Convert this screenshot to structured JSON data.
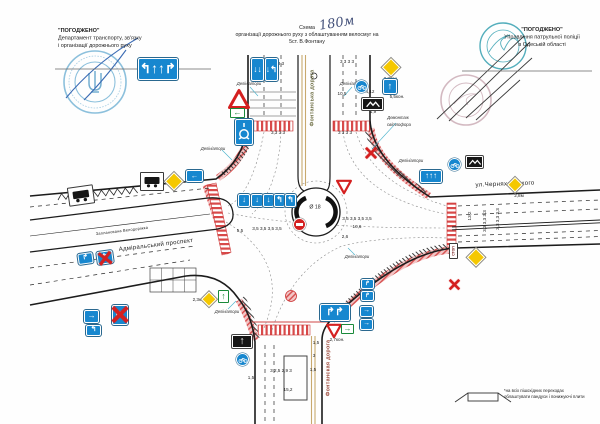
{
  "approvals": {
    "left": {
      "title": "\"ПОГОДЖЕНО\"",
      "line1": "Департамент транспорту, зв'язку",
      "line2": "і організації дорожнього руху"
    },
    "right": {
      "title": "\"ПОГОДЖЕНО\"",
      "line1": "Управління патрульної поліції",
      "line2": "в Одеській області"
    }
  },
  "title": {
    "word": "Схема",
    "handwritten": "180м",
    "line2": "організації дорожнього руху з облаштуванням велосмуг на",
    "line3": "5ст. В.Фонтану"
  },
  "footnote": {
    "line1": "*на всіх пішохідних переходах",
    "line2": "облаштувати пандуси і понижуючі плити"
  },
  "colors": {
    "sign_blue": "#1787cf",
    "diamond_yellow": "#f5c800",
    "marking_red": "#d85454",
    "stamp_blue": "#8cc0dc",
    "stamp_teal": "#54aebc",
    "ink_blue": "#3c6cb4"
  },
  "labels": [
    {
      "n": "street-label-north",
      "t": "Фонтанська дорога",
      "x": 312,
      "y": 98,
      "r": -90,
      "c": "olive street",
      "fs": 5.4
    },
    {
      "n": "street-label-south",
      "t": "Фонтанская дорога",
      "x": 328,
      "y": 368,
      "r": -90,
      "c": "rust street",
      "fs": 5.4
    },
    {
      "n": "street-label-east",
      "t": "ул.Черняховського",
      "x": 505,
      "y": 184,
      "r": -2,
      "c": "street",
      "fs": 6.2
    },
    {
      "n": "street-label-west",
      "t": "Адміральський проспект",
      "x": 156,
      "y": 245,
      "r": -7,
      "c": "street",
      "fs": 6.0
    },
    {
      "n": "bike-lane-label",
      "t": "Запланована Велодоріжка",
      "x": 122,
      "y": 231,
      "r": -7,
      "c": "street",
      "fs": 3.9
    },
    {
      "n": "delineators-label",
      "t": "Делініатори",
      "x": 249,
      "y": 84,
      "c": "annot",
      "fs": 4.2
    },
    {
      "n": "delineators-label",
      "t": "Делініатори",
      "x": 352,
      "y": 84,
      "c": "annot",
      "fs": 4.2
    },
    {
      "n": "delineators-label",
      "t": "Делініатори",
      "x": 213,
      "y": 149,
      "c": "annot",
      "fs": 4.2
    },
    {
      "n": "delineators-label",
      "t": "Делініатори",
      "x": 411,
      "y": 161,
      "c": "annot",
      "fs": 4.2
    },
    {
      "n": "delineators-label",
      "t": "Делініатори",
      "x": 227,
      "y": 312,
      "c": "annot",
      "fs": 4.2
    },
    {
      "n": "delineators-label",
      "t": "Делініатори",
      "x": 357,
      "y": 257,
      "c": "annot",
      "fs": 4.2
    },
    {
      "n": "demontage-label",
      "t": "Демонтаж",
      "x": 398,
      "y": 118,
      "c": "annot",
      "fs": 4.2
    },
    {
      "n": "demontage-label",
      "t": "світлофора",
      "x": 399,
      "y": 125,
      "c": "annot",
      "fs": 4.2
    },
    {
      "n": "roundabout-diameter",
      "t": "Ø 18",
      "x": 315,
      "y": 207,
      "fs": 5.2
    },
    {
      "n": "dimension-label",
      "t": "1,7",
      "x": 253,
      "y": 61
    },
    {
      "n": "dimension-label",
      "t": "3,3 3 3",
      "x": 277,
      "y": 64
    },
    {
      "n": "dimension-label",
      "t": "3 3 3 3",
      "x": 347,
      "y": 62
    },
    {
      "n": "dimension-label",
      "t": "10,5",
      "x": 342,
      "y": 94
    },
    {
      "n": "dimension-label",
      "t": "3,3 3 3",
      "x": 278,
      "y": 133
    },
    {
      "n": "dimension-label",
      "t": "3 3 3 3",
      "x": 345,
      "y": 133
    },
    {
      "n": "dimension-label",
      "t": "2,3кон.",
      "x": 391,
      "y": 79
    },
    {
      "n": "dimension-label",
      "t": "5,5кон.",
      "x": 397,
      "y": 97
    },
    {
      "n": "dimension-label",
      "t": "4,12",
      "x": 370,
      "y": 92
    },
    {
      "n": "dimension-label",
      "t": "1,9",
      "x": 373,
      "y": 112
    },
    {
      "n": "dimension-label",
      "t": "5,5",
      "x": 240,
      "y": 231
    },
    {
      "n": "dimension-label",
      "t": "3,5 3,5 3,5 3,5",
      "x": 267,
      "y": 229
    },
    {
      "n": "dimension-label",
      "t": "3,5 3,5 3,5 3,5",
      "x": 357,
      "y": 219
    },
    {
      "n": "dimension-label",
      "t": "10,6",
      "x": 357,
      "y": 227
    },
    {
      "n": "dimension-label",
      "t": "2,6",
      "x": 345,
      "y": 237
    },
    {
      "n": "dimension-label",
      "t": "13,2",
      "x": 470,
      "y": 216,
      "r": -90
    },
    {
      "n": "dimension-label",
      "t": "3,3 3,3 3,3",
      "x": 485,
      "y": 221,
      "r": -90
    },
    {
      "n": "dimension-label",
      "t": "3,3 3,3 3,3",
      "x": 498,
      "y": 219,
      "r": -90
    },
    {
      "n": "dimension-label",
      "t": "2,8м",
      "x": 519,
      "y": 196
    },
    {
      "n": "dimension-label",
      "t": "5,6",
      "x": 328,
      "y": 321
    },
    {
      "n": "dimension-label",
      "t": "2,7кон.",
      "x": 337,
      "y": 340
    },
    {
      "n": "dimension-label",
      "t": "1,5",
      "x": 316,
      "y": 343
    },
    {
      "n": "dimension-label",
      "t": "3",
      "x": 314,
      "y": 356
    },
    {
      "n": "dimension-label",
      "t": "1,5",
      "x": 313,
      "y": 370
    },
    {
      "n": "dimension-label",
      "t": "3 2,5 2,9 3",
      "x": 281,
      "y": 371
    },
    {
      "n": "dimension-label",
      "t": "15,2",
      "x": 288,
      "y": 390
    },
    {
      "n": "dimension-label",
      "t": "1,5",
      "x": 251,
      "y": 378
    },
    {
      "n": "dimension-label",
      "t": "2,3кон.",
      "x": 200,
      "y": 300
    }
  ],
  "signs": [
    {
      "n": "lane-control-board",
      "type": "blue",
      "x": 138,
      "y": 58,
      "w": 40,
      "h": 22,
      "g": "↰↑↑↱"
    },
    {
      "n": "lane-sign",
      "type": "blue",
      "x": 251,
      "y": 58,
      "w": 13,
      "h": 23,
      "g": "↓↓"
    },
    {
      "n": "lane-sign",
      "type": "blue",
      "x": 265,
      "y": 58,
      "w": 13,
      "h": 23,
      "g": "↓↰"
    },
    {
      "n": "warning-triangle-sign",
      "type": "tri",
      "x": 228,
      "y": 88,
      "w": 22
    },
    {
      "n": "green-arrow-sign",
      "type": "green",
      "x": 230,
      "y": 108,
      "w": 15,
      "h": 10,
      "g": "←"
    },
    {
      "n": "roundabout-scheme-sign",
      "type": "rnd",
      "x": 235,
      "y": 119,
      "w": 18,
      "h": 26
    },
    {
      "n": "bus-stop-sign",
      "type": "bus",
      "x": 140,
      "y": 172,
      "w": 24,
      "h": 19
    },
    {
      "n": "bus-stop-sign",
      "type": "bus",
      "x": 68,
      "y": 186,
      "w": 26,
      "h": 19,
      "r": -8
    },
    {
      "n": "priority-road-sign",
      "type": "yd",
      "x": 165,
      "y": 172,
      "w": 17
    },
    {
      "n": "left-arrow-sign",
      "type": "blue",
      "x": 186,
      "y": 170,
      "w": 17,
      "h": 12,
      "g": "←"
    },
    {
      "n": "lane-sign",
      "type": "blue",
      "x": 238,
      "y": 194,
      "w": 12,
      "h": 13,
      "g": "↓"
    },
    {
      "n": "lane-sign",
      "type": "blue",
      "x": 251,
      "y": 194,
      "w": 12,
      "h": 13,
      "g": "↓"
    },
    {
      "n": "lane-sign",
      "type": "blue",
      "x": 263,
      "y": 194,
      "w": 11,
      "h": 13,
      "g": "↓"
    },
    {
      "n": "lane-sign",
      "type": "blue",
      "x": 274,
      "y": 194,
      "w": 11,
      "h": 13,
      "g": "↰"
    },
    {
      "n": "lane-sign",
      "type": "blue",
      "x": 285,
      "y": 194,
      "w": 11,
      "h": 13,
      "g": "↰"
    },
    {
      "n": "no-entry-sign",
      "type": "noentry",
      "x": 293,
      "y": 218,
      "w": 13
    },
    {
      "n": "give-way-sign",
      "type": "yield",
      "x": 336,
      "y": 179,
      "w": 16
    },
    {
      "n": "priority-road-sign",
      "type": "yd",
      "x": 382,
      "y": 58,
      "w": 17
    },
    {
      "n": "bicycle-route-sign",
      "type": "bike",
      "x": 355,
      "y": 80,
      "w": 13
    },
    {
      "n": "straight-ahead-sign",
      "type": "blue",
      "x": 383,
      "y": 79,
      "w": 14,
      "h": 15,
      "g": "↑"
    },
    {
      "n": "route-plate-sign",
      "type": "black",
      "x": 362,
      "y": 98,
      "w": 21,
      "h": 12
    },
    {
      "n": "demontage-x-mark",
      "type": "xmark",
      "x": 363,
      "y": 146,
      "w": 16
    },
    {
      "n": "bicycle-route-sign",
      "type": "bike",
      "x": 448,
      "y": 158,
      "w": 13
    },
    {
      "n": "route-plate-sign",
      "type": "black",
      "x": 466,
      "y": 156,
      "w": 17,
      "h": 12
    },
    {
      "n": "lane-control-board",
      "type": "blue",
      "x": 420,
      "y": 170,
      "w": 22,
      "h": 13,
      "g": "↑↑↑"
    },
    {
      "n": "priority-road-sign",
      "type": "yd",
      "x": 507,
      "y": 177,
      "w": 15
    },
    {
      "n": "stop-plate",
      "type": "stop",
      "x": 449,
      "y": 243,
      "w": 9,
      "h": 16,
      "g": "СТОП"
    },
    {
      "n": "priority-road-sign",
      "type": "yd",
      "x": 467,
      "y": 248,
      "w": 17
    },
    {
      "n": "demontage-x-mark",
      "type": "xmark",
      "x": 447,
      "y": 277,
      "w": 15
    },
    {
      "n": "give-way-sign",
      "type": "yield",
      "x": 326,
      "y": 323,
      "w": 16
    },
    {
      "n": "green-arrow-sign",
      "type": "green",
      "x": 341,
      "y": 324,
      "w": 13,
      "h": 10,
      "g": "→"
    },
    {
      "n": "lane-control-board",
      "type": "blue",
      "x": 320,
      "y": 304,
      "w": 30,
      "h": 17,
      "g": "↱↱"
    },
    {
      "n": "lane-sign",
      "type": "blue",
      "x": 361,
      "y": 279,
      "w": 13,
      "h": 10,
      "g": "↱"
    },
    {
      "n": "lane-sign",
      "type": "blue",
      "x": 361,
      "y": 291,
      "w": 13,
      "h": 10,
      "g": "↱"
    },
    {
      "n": "lane-sign",
      "type": "blue",
      "x": 360,
      "y": 306,
      "w": 13,
      "h": 11,
      "g": "→"
    },
    {
      "n": "lane-sign",
      "type": "blue",
      "x": 360,
      "y": 319,
      "w": 13,
      "h": 11,
      "g": "→"
    },
    {
      "n": "route-direction-sign",
      "type": "blackup",
      "x": 232,
      "y": 335,
      "w": 20,
      "h": 13,
      "g": "↑"
    },
    {
      "n": "bicycle-route-sign",
      "type": "bike",
      "x": 236,
      "y": 353,
      "w": 13
    },
    {
      "n": "priority-road-sign",
      "type": "yd",
      "x": 202,
      "y": 292,
      "w": 14
    },
    {
      "n": "green-arrow-sign",
      "type": "green",
      "x": 218,
      "y": 290,
      "w": 11,
      "h": 13,
      "g": "↑"
    },
    {
      "n": "lane-sign",
      "type": "blue",
      "x": 78,
      "y": 253,
      "w": 15,
      "h": 11,
      "g": "↱",
      "r": -8
    },
    {
      "n": "lane-sign",
      "type": "blue",
      "x": 97,
      "y": 251,
      "w": 16,
      "h": 13,
      "g": "↰",
      "r": -8,
      "X": 1
    },
    {
      "n": "lane-sign",
      "type": "blue",
      "x": 84,
      "y": 310,
      "w": 15,
      "h": 13,
      "g": "→"
    },
    {
      "n": "lane-sign",
      "type": "blue",
      "x": 86,
      "y": 325,
      "w": 15,
      "h": 11,
      "g": "↰"
    },
    {
      "n": "lane-sign",
      "type": "blue",
      "x": 112,
      "y": 305,
      "w": 16,
      "h": 20,
      "g": "↖",
      "X": 1
    }
  ]
}
